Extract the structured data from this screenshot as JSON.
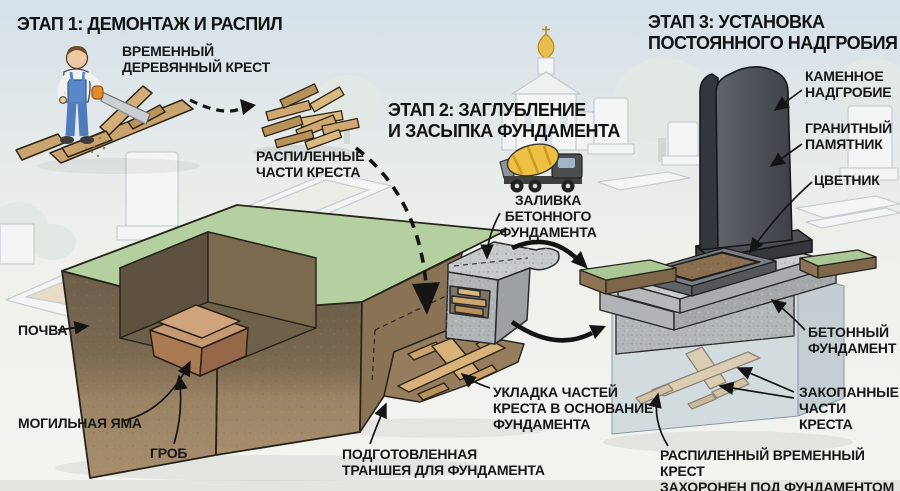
{
  "infographic": {
    "language": "ru",
    "topic": "Замена временного креста на постоянное надгробие"
  },
  "stage1": {
    "title": "ЭТАП 1: ДЕМОНТАЖ И РАСПИЛ",
    "labels": {
      "temporary_cross": "ВРЕМЕННЫЙ\nДЕРЕВЯННЫЙ КРЕСТ",
      "sawn_parts": "РАСПИЛЕННЫЕ\nЧАСТИ КРЕСТА"
    }
  },
  "stage2": {
    "title": "ЭТАП 2: ЗАГЛУБЛЕНИЕ\nИ ЗАСЫПКА ФУНДАМЕНТА",
    "labels": {
      "concrete_pour": "ЗАЛИВКА\nБЕТОННОГО\nФУНДАМЕНТА",
      "laying": "УКЛАДКА ЧАСТЕЙ\nКРЕСТА В ОСНОВАНИЕ\nФУНДАМЕНТА",
      "trench": "ПОДГОТОВЛЕННАЯ\nТРАНШЕЯ ДЛЯ ФУНДАМЕНТА"
    }
  },
  "stage3": {
    "title": "ЭТАП 3: УСТАНОВКА\nПОСТОЯННОГО НАДГРОБИЯ",
    "labels": {
      "stone_tombstone": "КАМЕННОЕ\nНАДГРОБИЕ",
      "granite_monument": "ГРАНИТНЫЙ\nПАМЯТНИК",
      "flower_garden": "ЦВЕТНИК",
      "concrete_foundation": "БЕТОННЫЙ\nФУНДАМЕНТ",
      "buried_parts": "ЗАКОПАННЫЕ\nЧАСТИ КРЕСТА",
      "buried_note": "РАСПИЛЕННЫЙ ВРЕМЕННЫЙ КРЕСТ\nЗАХОРОНЕН ПОД ФУНДАМЕНТОМ"
    }
  },
  "cutaway": {
    "labels": {
      "soil": "ПОЧВА",
      "grave_pit": "МОГИЛЬНАЯ ЯМА",
      "coffin": "ГРОБ"
    }
  },
  "icons": {
    "saw": "saw-icon",
    "cement_truck": "cement-mixer-truck-icon",
    "church": "church-icon",
    "dashed_arrow": "dashed-arrow-icon",
    "curved_arrow": "curved-arrow-icon"
  },
  "palette": {
    "grass": "#b4cfa0",
    "soil_dark": "#6d5e49",
    "soil_light": "#a18a6a",
    "wood": "#c9a470",
    "pale_wood": "#dccdb2",
    "concrete": "#b7bbbd",
    "granite": "#4b4f54",
    "truck_yellow": "#eec044",
    "coffin": "#a97a54",
    "arrow": "#141414",
    "text": "#171717",
    "sky": "#d5e0e9"
  }
}
